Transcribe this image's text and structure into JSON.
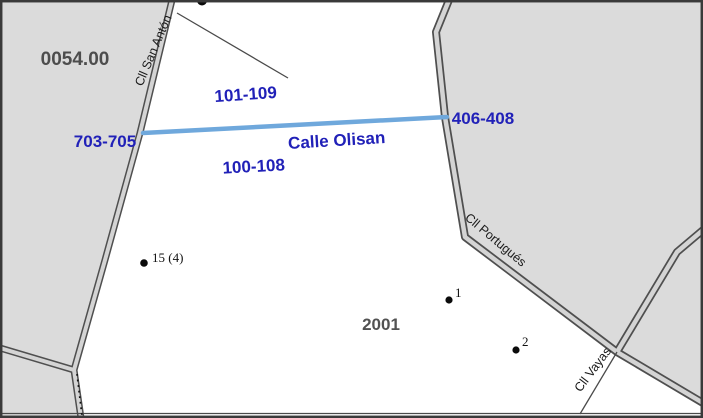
{
  "map": {
    "region_code": "0054.00",
    "block_label": "2001",
    "streets": {
      "san_anton": "Cll San Antón",
      "olisan": "Calle Olisan",
      "portugues": "Cll Portugués",
      "vayas": "Cll Vayas"
    },
    "address_ranges": {
      "north_olisan": "101-109",
      "west_olisan": "703-705",
      "south_olisan": "100-108",
      "east_olisan": "406-408"
    },
    "points": {
      "p15": "15 (4)",
      "p1": "1",
      "p2": "2"
    },
    "colors": {
      "parcel_fill": "#dbdbdb",
      "road_casing": "#4f4f4f",
      "road_fill": "#d4d4d4",
      "highlight_street": "#6fa8dc",
      "label_blue": "#2121b8",
      "label_gray": "#4d4d4d",
      "background": "#ffffff"
    }
  }
}
